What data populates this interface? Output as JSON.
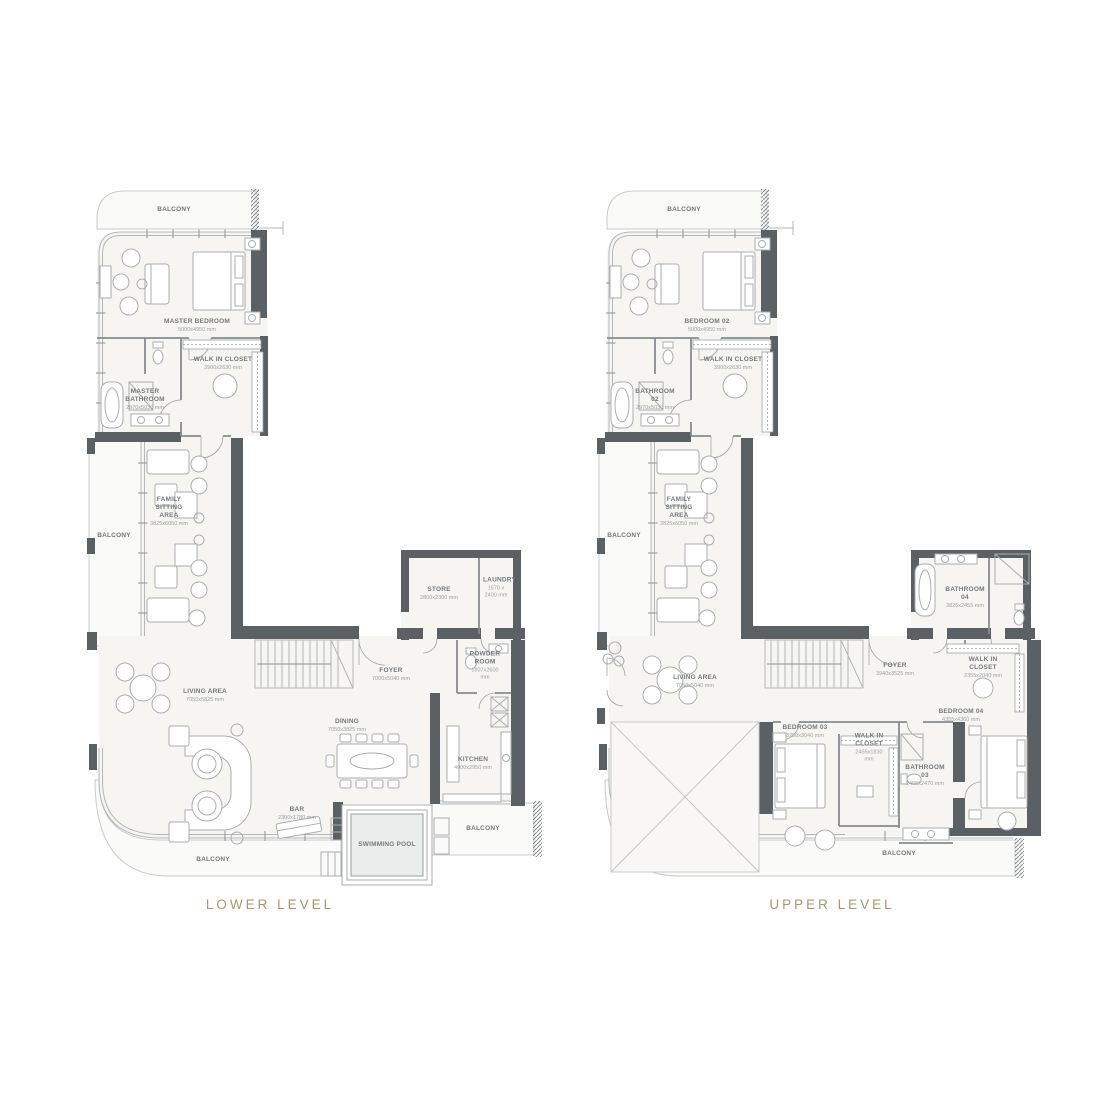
{
  "page": {
    "background": "#ffffff"
  },
  "colors": {
    "wall": "#5b6065",
    "floor": "#f6f5f2",
    "balcony": "#fafaf9",
    "pool": "#e9edeb",
    "label_text": "#74797d",
    "dims_text": "#9ca0a3",
    "title_accent": "#a6996d"
  },
  "plans": [
    {
      "title": "LOWER LEVEL",
      "labels": [
        {
          "name": "label-balcony-top",
          "t": "BALCONY",
          "x": 89,
          "y": 22
        },
        {
          "name": "label-master-bedroom",
          "t": "MASTER BEDROOM",
          "d": "5000x4950 mm",
          "x": 112,
          "y": 138
        },
        {
          "name": "label-walk-in-closet",
          "t": "WALK IN CLOSET",
          "d": "3900x2630 mm",
          "x": 138,
          "y": 176
        },
        {
          "name": "label-master-bathroom",
          "t": "MASTER BATHROOM",
          "d": "2970x5030 mm",
          "x": 60,
          "y": 212,
          "w": 46
        },
        {
          "name": "label-balcony-left",
          "t": "BALCONY",
          "x": 29,
          "y": 348
        },
        {
          "name": "label-family-sitting-area",
          "t": "FAMILY SITTING AREA",
          "d": "3825x6050 mm",
          "x": 84,
          "y": 324,
          "w": 40
        },
        {
          "name": "label-living-area",
          "t": "LIVING AREA",
          "d": "7050x5825 mm",
          "x": 120,
          "y": 508
        },
        {
          "name": "label-dining",
          "t": "DINING",
          "d": "7050x3825 mm",
          "x": 262,
          "y": 538
        },
        {
          "name": "label-foyer",
          "t": "FOYER",
          "d": "7000x5040 mm",
          "x": 306,
          "y": 487
        },
        {
          "name": "label-store",
          "t": "STORE",
          "d": "2800x2300 mm",
          "x": 354,
          "y": 406,
          "w": 40
        },
        {
          "name": "label-laundry",
          "t": "LAUNDRY",
          "d": "1570 x 2400 mm",
          "x": 411,
          "y": 400,
          "w": 26
        },
        {
          "name": "label-powder-room",
          "t": "POWDER ROOM",
          "d": "1807x2600 mm",
          "x": 400,
          "y": 478,
          "w": 32
        },
        {
          "name": "label-kitchen",
          "t": "KITCHEN",
          "d": "4000x2950 mm",
          "x": 388,
          "y": 576,
          "w": 40
        },
        {
          "name": "label-bar",
          "t": "BAR",
          "d": "2300x1780 mm",
          "x": 212,
          "y": 626,
          "w": 40
        },
        {
          "name": "label-swimming-pool",
          "t": "SWIMMING POOL",
          "x": 302,
          "y": 657,
          "w": 60
        },
        {
          "name": "label-balcony-bottom",
          "t": "BALCONY",
          "x": 128,
          "y": 672
        },
        {
          "name": "label-balcony-right",
          "t": "BALCONY",
          "x": 398,
          "y": 641
        }
      ]
    },
    {
      "title": "UPPER LEVEL",
      "labels": [
        {
          "name": "label-balcony-top",
          "t": "BALCONY",
          "x": 89,
          "y": 22
        },
        {
          "name": "label-bedroom-02",
          "t": "BEDROOM 02",
          "d": "5000x4950 mm",
          "x": 112,
          "y": 138
        },
        {
          "name": "label-walk-in-closet-02",
          "t": "WALK IN CLOSET",
          "d": "3900x2630 mm",
          "x": 138,
          "y": 176
        },
        {
          "name": "label-bathroom-02",
          "t": "BATHROOM 02",
          "d": "2970x5030 mm",
          "x": 60,
          "y": 212,
          "w": 46
        },
        {
          "name": "label-balcony-left",
          "t": "BALCONY",
          "x": 29,
          "y": 348
        },
        {
          "name": "label-family-sitting-area",
          "t": "FAMILY SITTING AREA",
          "d": "3825x6050 mm",
          "x": 84,
          "y": 324,
          "w": 40
        },
        {
          "name": "label-living-area",
          "t": "LIVING AREA",
          "d": "7050x5040 mm",
          "x": 100,
          "y": 494
        },
        {
          "name": "label-foyer",
          "t": "FOYER",
          "d": "3940x3525 mm",
          "x": 300,
          "y": 482
        },
        {
          "name": "label-bathroom-04",
          "t": "BATHROOM 04",
          "d": "3825x2455 mm",
          "x": 370,
          "y": 410,
          "w": 46
        },
        {
          "name": "label-walk-in-closet-04",
          "t": "WALK IN CLOSET",
          "d": "2355x2040 mm",
          "x": 388,
          "y": 480,
          "w": 50
        },
        {
          "name": "label-bedroom-04",
          "t": "BEDROOM 04",
          "d": "4355x4360 mm",
          "x": 366,
          "y": 528,
          "w": 46
        },
        {
          "name": "label-bedroom-03",
          "t": "BEDROOM 03",
          "d": "3250x3040 mm",
          "x": 210,
          "y": 544,
          "w": 46
        },
        {
          "name": "label-walk-in-closet-03",
          "t": "WALK IN CLOSET",
          "d": "2455x1830 mm",
          "x": 274,
          "y": 560,
          "w": 34
        },
        {
          "name": "label-bathroom-03",
          "t": "BATHROOM 03",
          "d": "2455x2470 mm",
          "x": 330,
          "y": 588,
          "w": 40
        },
        {
          "name": "label-balcony-bottom",
          "t": "BALCONY",
          "x": 304,
          "y": 666
        }
      ]
    }
  ]
}
